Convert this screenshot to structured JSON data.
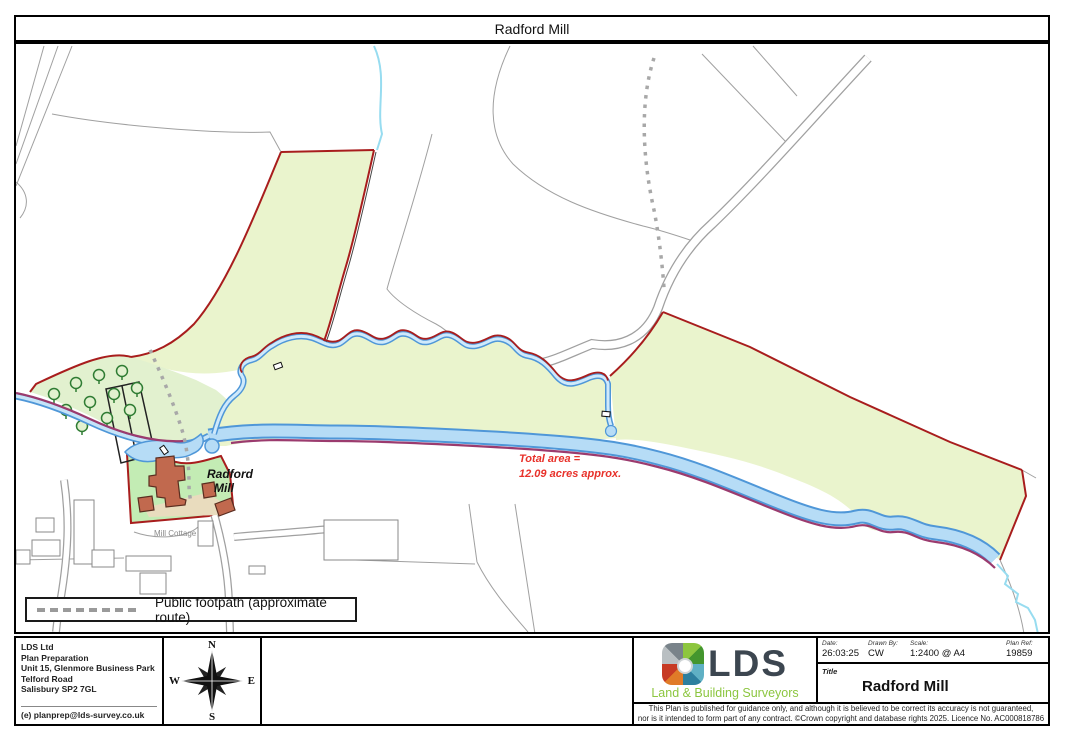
{
  "window": {
    "title": "Radford Mill"
  },
  "map": {
    "property_label_line1": "Radford",
    "property_label_line2": "Mill",
    "cottage_label": "Mill Cottage",
    "area_note_line1": "Total area =",
    "area_note_line2": "12.09 acres approx.",
    "legend": {
      "text": "Public footpath (approximate route)"
    },
    "colors": {
      "parcel_fill": "#eaf4cd",
      "woodland_fill": "#e2f1cf",
      "homestead_fill": "#c3ecb4",
      "yard_fill": "#e9dcbe",
      "boundary_red": "#a81d1d",
      "boundary_purple": "#9b3b6e",
      "river_edge": "#4f97d8",
      "river_fill": "#b6dcf6",
      "stream_cyan": "#97dcf0",
      "building_fill": "#c1694e",
      "road_gray": "#a0a0a0",
      "annotation_red": "#e8312a"
    }
  },
  "footer": {
    "company": {
      "lines": [
        "LDS Ltd",
        "Plan Preparation",
        "Unit 15, Glenmore Business Park",
        "Telford Road",
        "Salisbury SP2 7GL"
      ],
      "email": "(e) planprep@lds-survey.co.uk"
    },
    "compass": {
      "n": "N",
      "e": "E",
      "s": "S",
      "w": "W"
    },
    "logo": {
      "text": "LDS",
      "tagline": "Land & Building Surveyors"
    },
    "meta": {
      "date_label": "Date:",
      "date_value": "26:03:25",
      "drawn_by_label": "Drawn By:",
      "drawn_by_value": "CW",
      "scale_label": "Scale:",
      "scale_value": "1:2400 @ A4",
      "plan_ref_label": "Plan Ref:",
      "plan_ref_value": "19859",
      "title_label": "Title",
      "title_value": "Radford Mill"
    },
    "disclaimer_line1": "This Plan is published for guidance only, and although it is believed to be correct its accuracy is not guaranteed,",
    "disclaimer_line2": "nor is it intended to form part of any contract. ©Crown copyright and database rights 2025. Licence No. AC000818786"
  }
}
